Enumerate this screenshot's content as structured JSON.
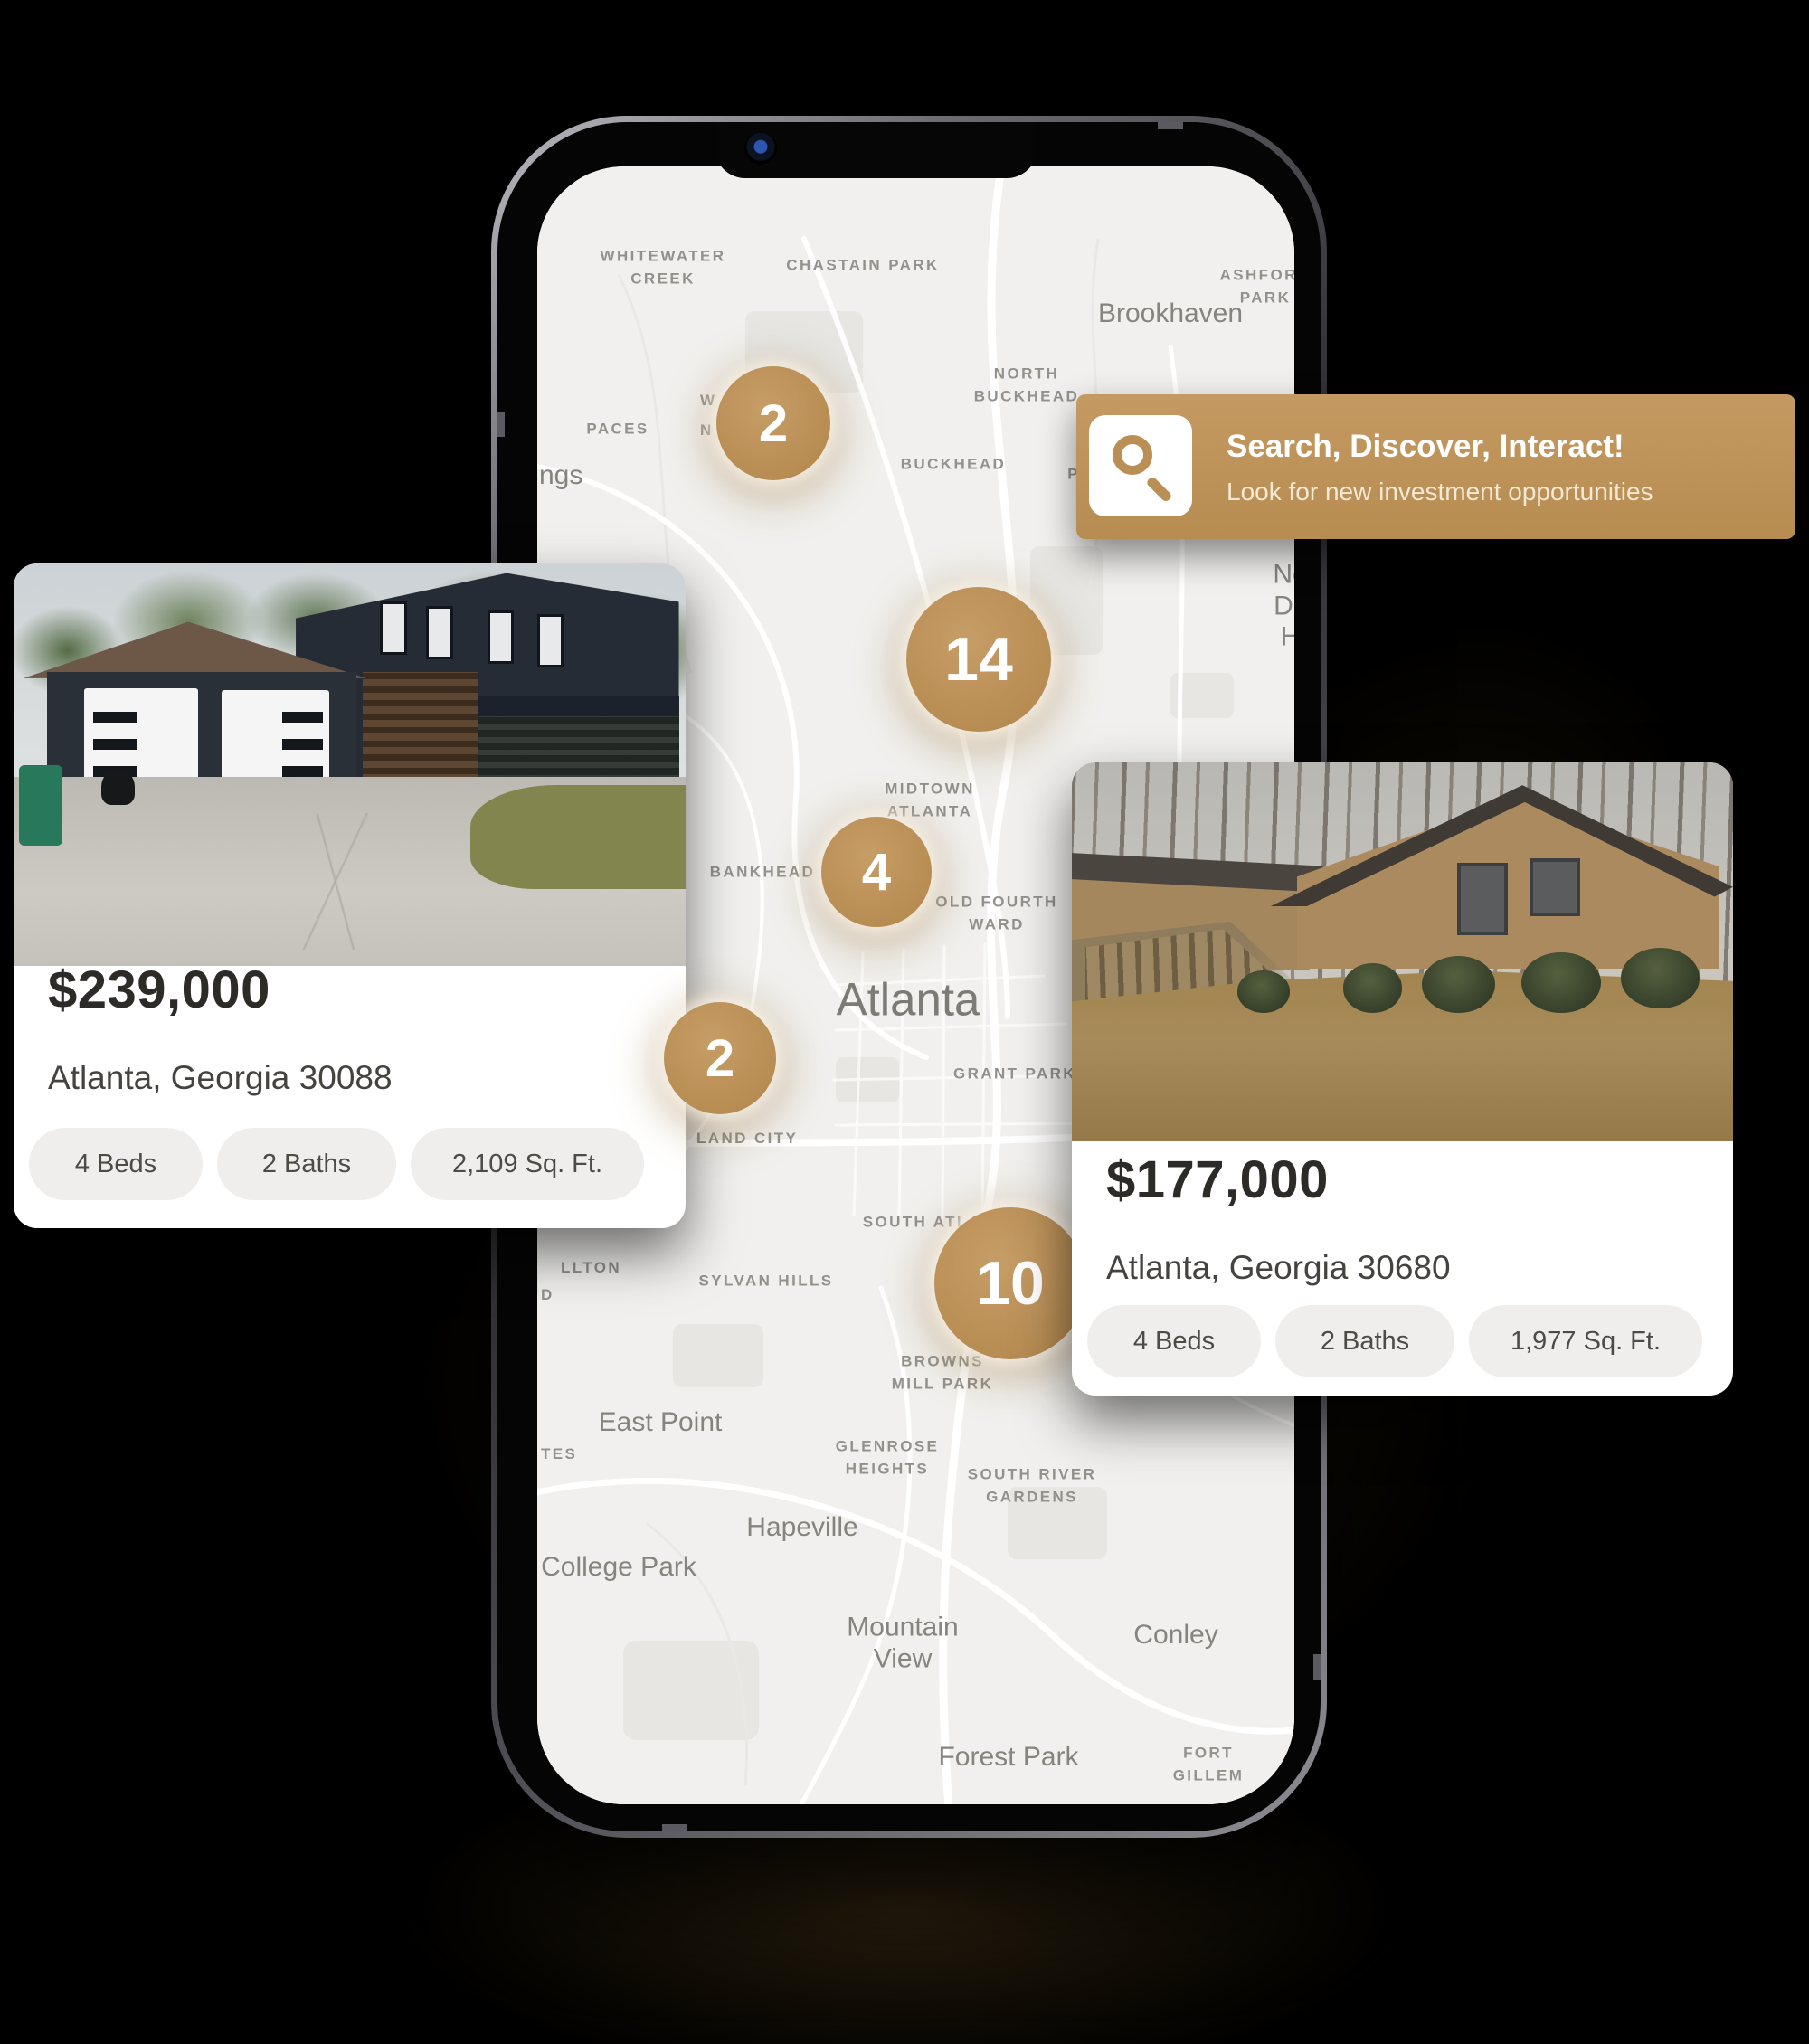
{
  "banner": {
    "title": "Search, Discover, Interact!",
    "subtitle": "Look for new investment opportunities"
  },
  "markers": {
    "counts": [
      "2",
      "14",
      "4",
      "2",
      "10"
    ]
  },
  "map": {
    "labels": [
      "ngs",
      "WHITEWATER\nCREEK",
      "CHASTAIN PARK",
      "ASHFORD PARK",
      "Brookhaven",
      "NORTH\nBUCKHEAD",
      "PACES",
      "BUCKHEAD",
      "PINE HILLS",
      "North\nDruid Hills",
      "W",
      "N",
      "MIDTOWN\nATLANTA",
      "North",
      "BANKHEAD",
      "OLD FOURTH\nWARD",
      "Atlanta",
      "GRANT PARK",
      "LAND CITY",
      "SOUTH ATLANTA",
      "LLTON",
      "D",
      "SYLVAN HILLS",
      "BROWNS\nMILL PARK",
      "East Point",
      "TES",
      "GLENROSE\nHEIGHTS",
      "SOUTH RIVER\nGARDENS",
      "Hapeville",
      "College Park",
      "Mountain\nView",
      "Conley",
      "Forest Park",
      "FORT GILLEM"
    ]
  },
  "cards": {
    "left": {
      "price": "$239,000",
      "location": "Atlanta, Georgia 30088",
      "features": [
        "4 Beds",
        "2 Baths",
        "2,109 Sq. Ft."
      ]
    },
    "right": {
      "price": "$177,000",
      "location": "Atlanta, Georgia 30680",
      "features": [
        "4 Beds",
        "2 Baths",
        "1,977 Sq. Ft."
      ]
    }
  },
  "colors": {
    "gold": "#bc9259",
    "map_bg": "#f1f0ee",
    "background": "#000000"
  }
}
